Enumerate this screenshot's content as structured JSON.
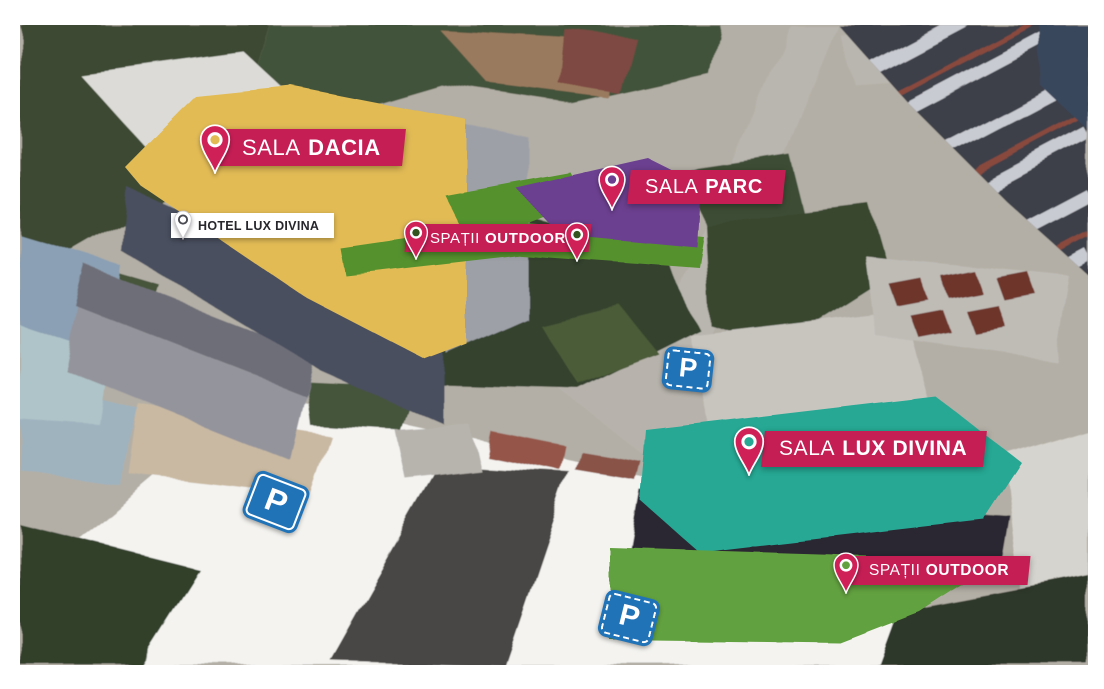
{
  "map": {
    "type": "aerial-venue-map",
    "frame_color": "#FFFFFF"
  },
  "labels": {
    "dacia": {
      "name": "SALA DACIA",
      "w1": "SALA",
      "w2": "DACIA"
    },
    "parc": {
      "name": "SALA PARC",
      "w1": "SALA",
      "w2": "PARC"
    },
    "lux": {
      "name": "SALA LUX DIVINA",
      "w1": "SALA",
      "w2": "LUX DIVINA"
    },
    "outdoor_top": {
      "name": "SPAȚII OUTDOOR",
      "w1": "SPAȚII",
      "w2": "OUTDOOR"
    },
    "outdoor_bottom": {
      "name": "SPAȚII OUTDOOR",
      "w1": "SPAȚII",
      "w2": "OUTDOOR"
    },
    "hotel": {
      "name": "HOTEL LUX DIVINA",
      "text": "HOTEL LUX DIVINA"
    }
  },
  "parking": {
    "symbol": "P",
    "count": 3,
    "sign_color": "#2173B8"
  },
  "colors": {
    "badge_bg": "#C51E55",
    "badge_text": "#FFFFFF",
    "pin_body": "#D02058",
    "dacia_area": "#E2BB55",
    "parc_area": "#6C4090",
    "lux_area": "#27A894",
    "outdoor_area_top": "#55922F",
    "outdoor_area_upper": "#55922F",
    "outdoor_area_bottom": "#62A13F",
    "outdoor_pin_dot": "#33531F",
    "parking_blue": "#2173B8",
    "hotel_bg": "#FFFFFF",
    "hotel_text": "#26262B",
    "hotel_pin_ring": "#4A4A52"
  }
}
